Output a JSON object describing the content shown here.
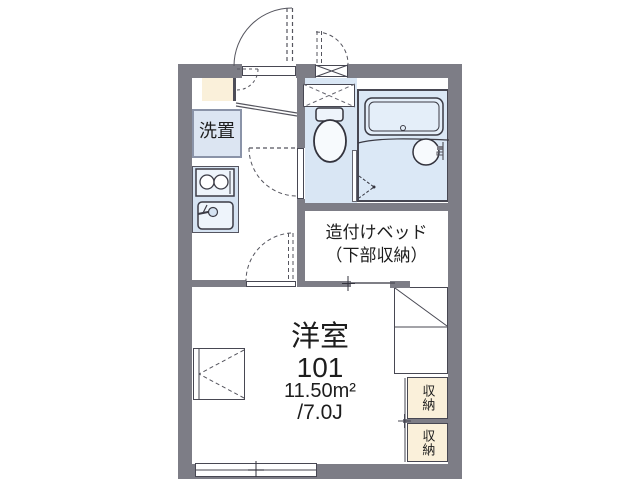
{
  "plan": {
    "title": "floor-plan-1k-unit",
    "room": {
      "type_label": "洋室",
      "number": "101",
      "area_sqm": "11.50m²",
      "area_tatami": "/7.0J"
    },
    "bed": {
      "line1": "造付けベッド",
      "line2": "（下部収納）"
    },
    "laundry_label": "洗置",
    "storage": [
      {
        "label": "収納"
      },
      {
        "label": "収納"
      }
    ],
    "fixtures": {
      "toilet": "toilet",
      "bathtub": "bathtub",
      "wash-basin": "wash-basin",
      "stove": "two-burner-stove",
      "sink": "kitchen-sink",
      "shoe-box": "shoe-box",
      "entrance-door": "entrance-door",
      "window": "window"
    },
    "colors": {
      "wall": "#7d7d86",
      "water_area_fill": "#d9e6f4",
      "bath_fill": "#dbe8f6",
      "laundry_fill": "#dce5f2",
      "kitchen_fill": "#d6e3f2",
      "storage_fill": "#faf0da",
      "line": "#474752",
      "text": "#1d1d1d"
    }
  }
}
